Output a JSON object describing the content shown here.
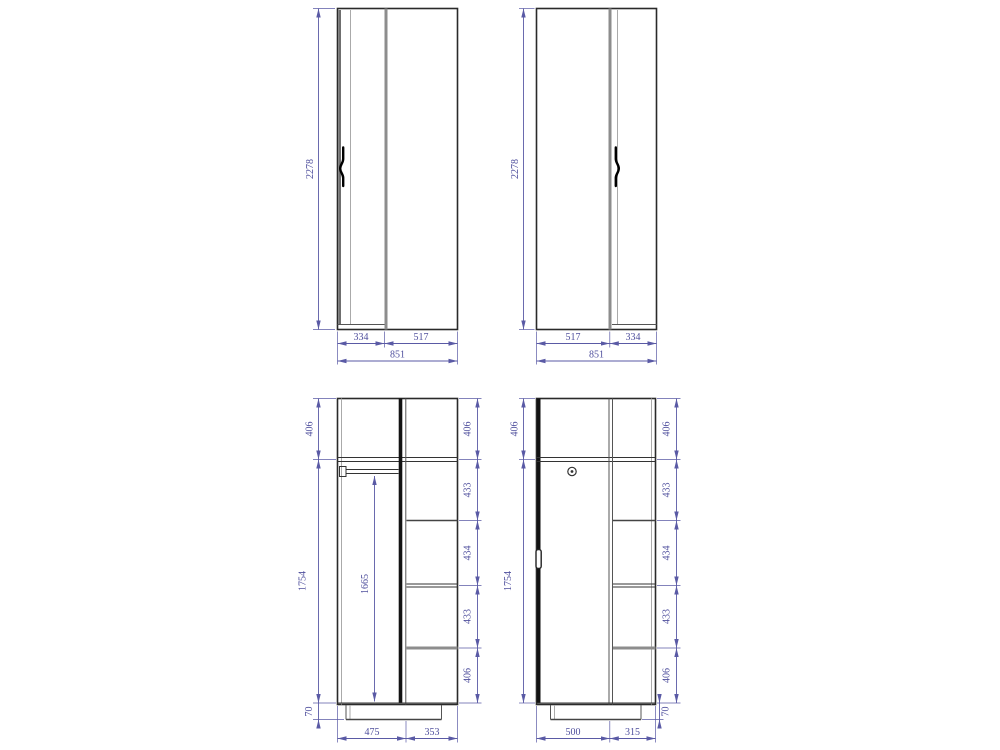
{
  "drawing_type": "wardrobe technical drawing, four orthographic views with dimensions",
  "colors": {
    "background": "#ffffff",
    "dimension": "#4f4f9d",
    "dimension_line": "#5a5aa5",
    "outline": "#2a2a2a",
    "panel_gray": "#8d8d8d",
    "door_black": "#121212"
  },
  "views": {
    "front_left": {
      "height": "2278",
      "door_width": "334",
      "panel_width": "517",
      "total_width": "851"
    },
    "front_right": {
      "height": "2278",
      "panel_width": "517",
      "door_width": "334",
      "total_width": "851"
    },
    "section_left": {
      "top_height": "406",
      "body_height": "1754",
      "plinth_height": "70",
      "hang_height": "1665",
      "right_heights": [
        "406",
        "433",
        "434",
        "433",
        "406"
      ],
      "bottom_widths": [
        "475",
        "353"
      ]
    },
    "section_right": {
      "top_height": "406",
      "body_height": "1754",
      "plinth_height": "70",
      "right_heights": [
        "406",
        "433",
        "434",
        "433",
        "406"
      ],
      "bottom_widths": [
        "500",
        "315"
      ]
    }
  }
}
